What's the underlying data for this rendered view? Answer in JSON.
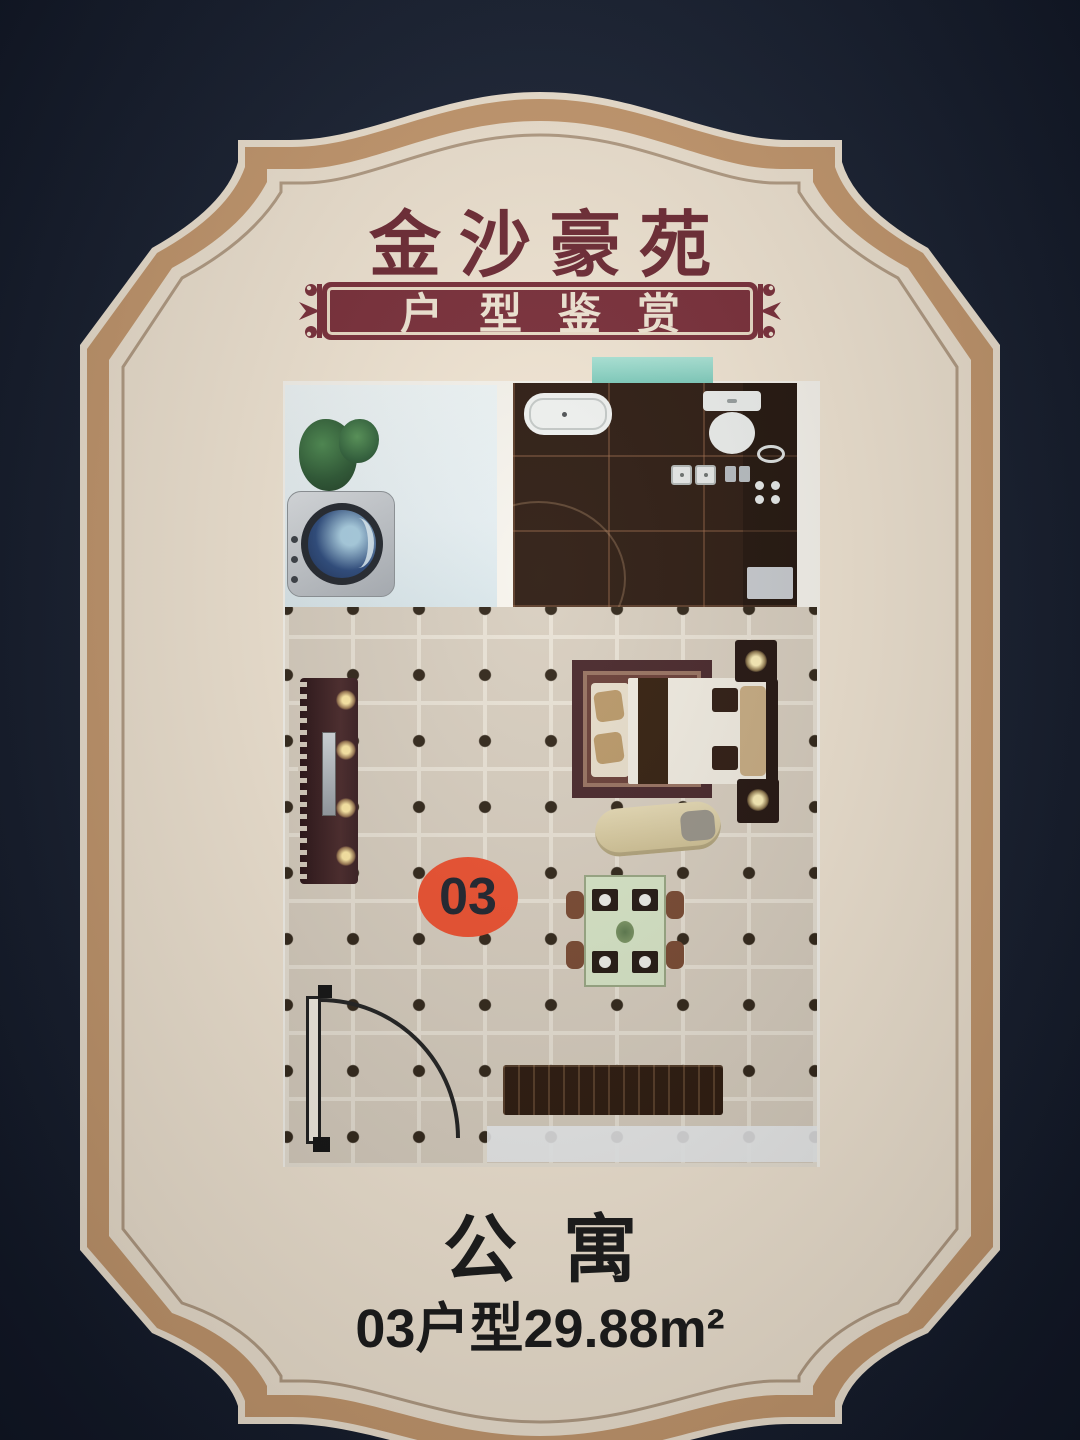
{
  "poster": {
    "title": "金沙豪苑",
    "banner_label": "户型鉴赏",
    "unit_badge": "03",
    "type_label": "公寓",
    "area_label": "03户型29.88m²"
  },
  "colors": {
    "background": "#1a2233",
    "panel_cream": "#f3e7d5",
    "band_tan": "#c89b70",
    "inner_line": "#b7a087",
    "title_maroon": "#6f2b35",
    "banner_bg": "#7b2f3a",
    "banner_text": "#f3e8d6",
    "badge_orange": "#ee5130",
    "badge_text": "#20242e",
    "text_black": "#1a1a1a",
    "floor_tile": "#d9cfc0",
    "grout": "#eae3d6",
    "dot_brown": "#32271a",
    "bathroom_dark": "#2e1c12",
    "laundry_blue": "#e7f0f3",
    "window_teal": "#8fd8c8",
    "wood_dark": "#2d1a0e"
  },
  "floorplan": {
    "rooms": [
      "laundry-balcony",
      "bathroom-kitchen",
      "main-living-bedroom"
    ],
    "furniture_icons": [
      "plant-icon",
      "washing-machine-icon",
      "window-icon",
      "bathtub-icon",
      "toilet-icon",
      "double-sink-icon",
      "kitchen-sink-icon",
      "stove-icon",
      "fridge-icon",
      "tv-cabinet-icon",
      "rug-icon",
      "bench-icon",
      "bed-icon",
      "nightstand-icon",
      "chaise-icon",
      "dining-table-icon",
      "console-cabinet-icon",
      "door-icon"
    ]
  }
}
